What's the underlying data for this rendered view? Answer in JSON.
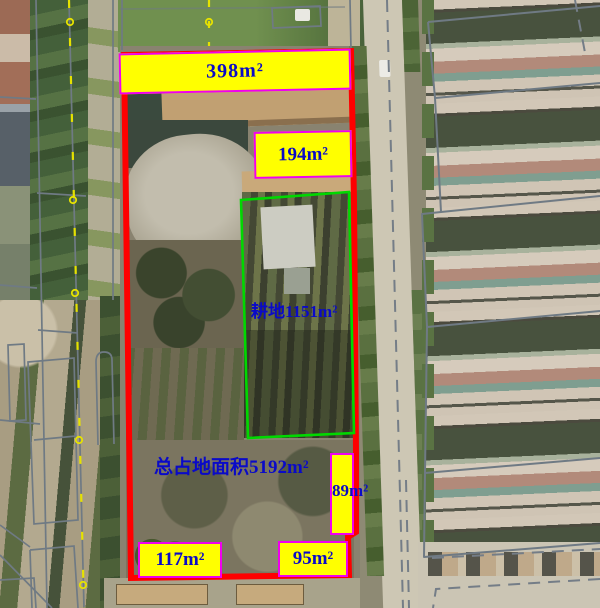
{
  "annotations": {
    "top_area": "398m²",
    "upper_area": "194m²",
    "cropland_area": "耕地1151m²",
    "total_area": "总占地面积5192m²",
    "right_area": "89m²",
    "bottom_left_area": "117m²",
    "bottom_right_area": "95m²"
  },
  "colors": {
    "parcel_boundary": "#FE0000",
    "cropland_boundary": "#00D800",
    "label_background": "#FFFF00",
    "label_border": "#F000F0",
    "label_text": "#0A0AC8",
    "cadastral_line": "#6F7A84",
    "utility_line": "#E6E200"
  }
}
